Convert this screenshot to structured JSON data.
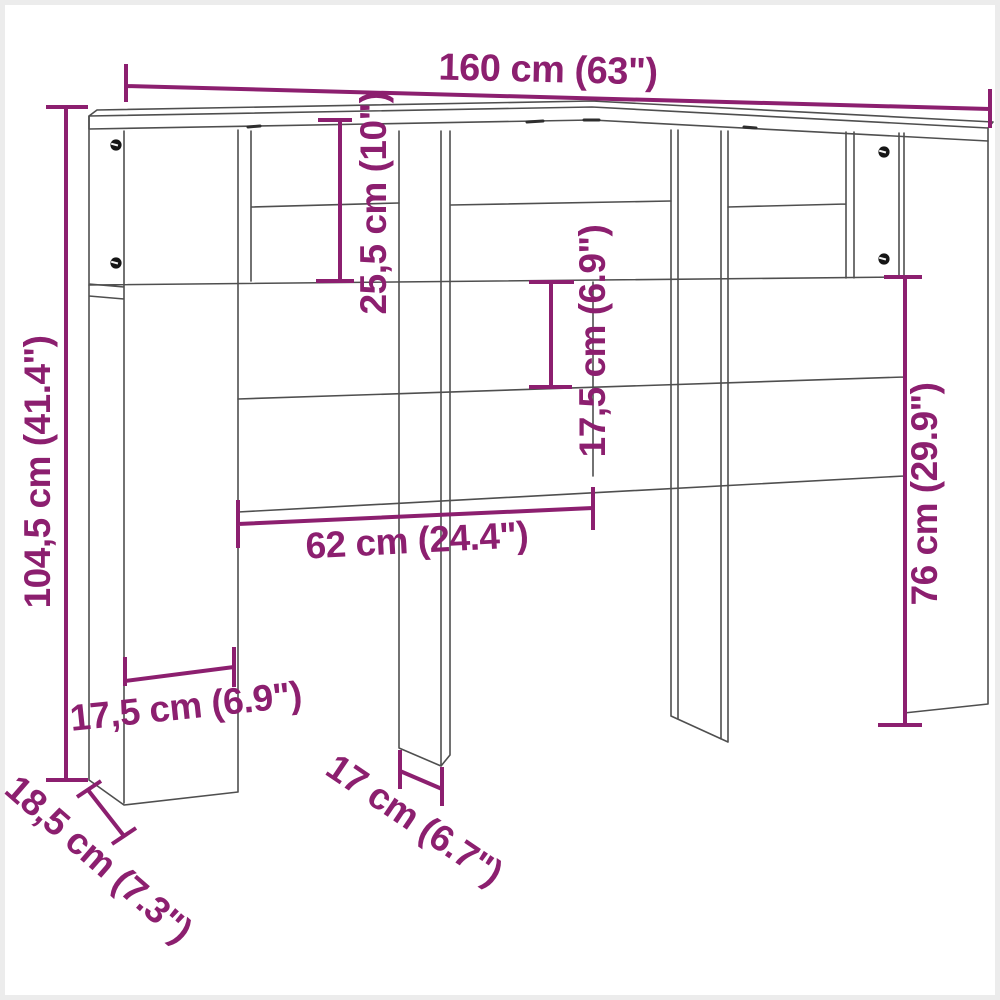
{
  "title": "Headboard cabinet dimension diagram",
  "colors": {
    "dimension": "#8C1F6F",
    "outline": "#4f4f4f",
    "background": "#ffffff"
  },
  "dimensions": {
    "total_width": "160 cm (63\")",
    "total_height": "104,5 cm (41.4\")",
    "top_shelf_height": "25,5 cm (10\")",
    "shelf_gap_height": "17,5 cm (6.9\")",
    "side_panel_height": "76 cm (29.9\")",
    "center_width": "62 cm (24.4\")",
    "column_width": "17,5 cm (6.9\")",
    "depth": "18,5 cm (7.3\")",
    "leg_width": "17 cm (6.7\")"
  }
}
